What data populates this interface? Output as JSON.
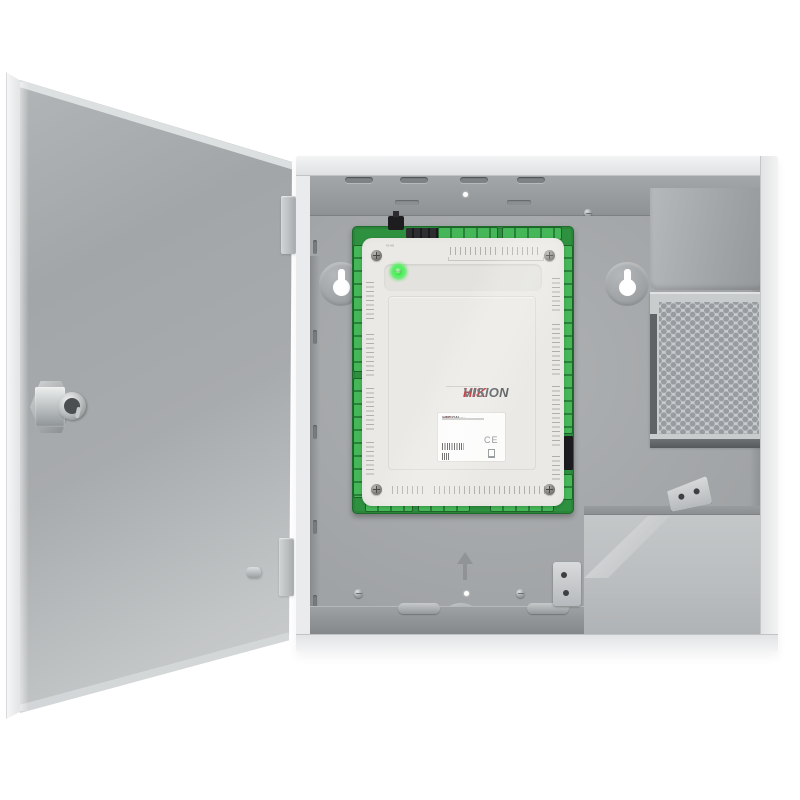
{
  "scene": {
    "description": "Hikvision access controller board mounted inside an open grey metal wall enclosure with power supply and battery bay",
    "background_color": "#ffffff"
  },
  "enclosure": {
    "door_color": "#aeb1b3",
    "flange_color": "#eceeee",
    "interior_color": "#a7aaac"
  },
  "board": {
    "pcb_color": "#2e9140",
    "terminal_color": "#46b758",
    "cover_color": "#eae9e5",
    "switch_label": "RS-485",
    "led_color": "#46e352",
    "leds": [
      {
        "label": "POWER"
      },
      {
        "label": "CLOCK"
      },
      {
        "label": "LNK"
      },
      {
        "label": "TRANS"
      },
      {
        "label": "ALARM"
      },
      {
        "label": "LOCK1"
      },
      {
        "label": "LOCK2"
      },
      {
        "label": "LOCK3"
      },
      {
        "label": "LOCK4"
      }
    ],
    "logo": {
      "hik": "HIK",
      "vision": "VISION"
    }
  },
  "sticker": {
    "logo_hik": "HIK",
    "logo_vision": "VISION",
    "product": "Access Controller",
    "ce": "CE"
  },
  "colors": {
    "logo_red": "#c4161c",
    "logo_gray": "#55595d",
    "led_green": "#46e352",
    "pcb_green": "#2e9140"
  }
}
